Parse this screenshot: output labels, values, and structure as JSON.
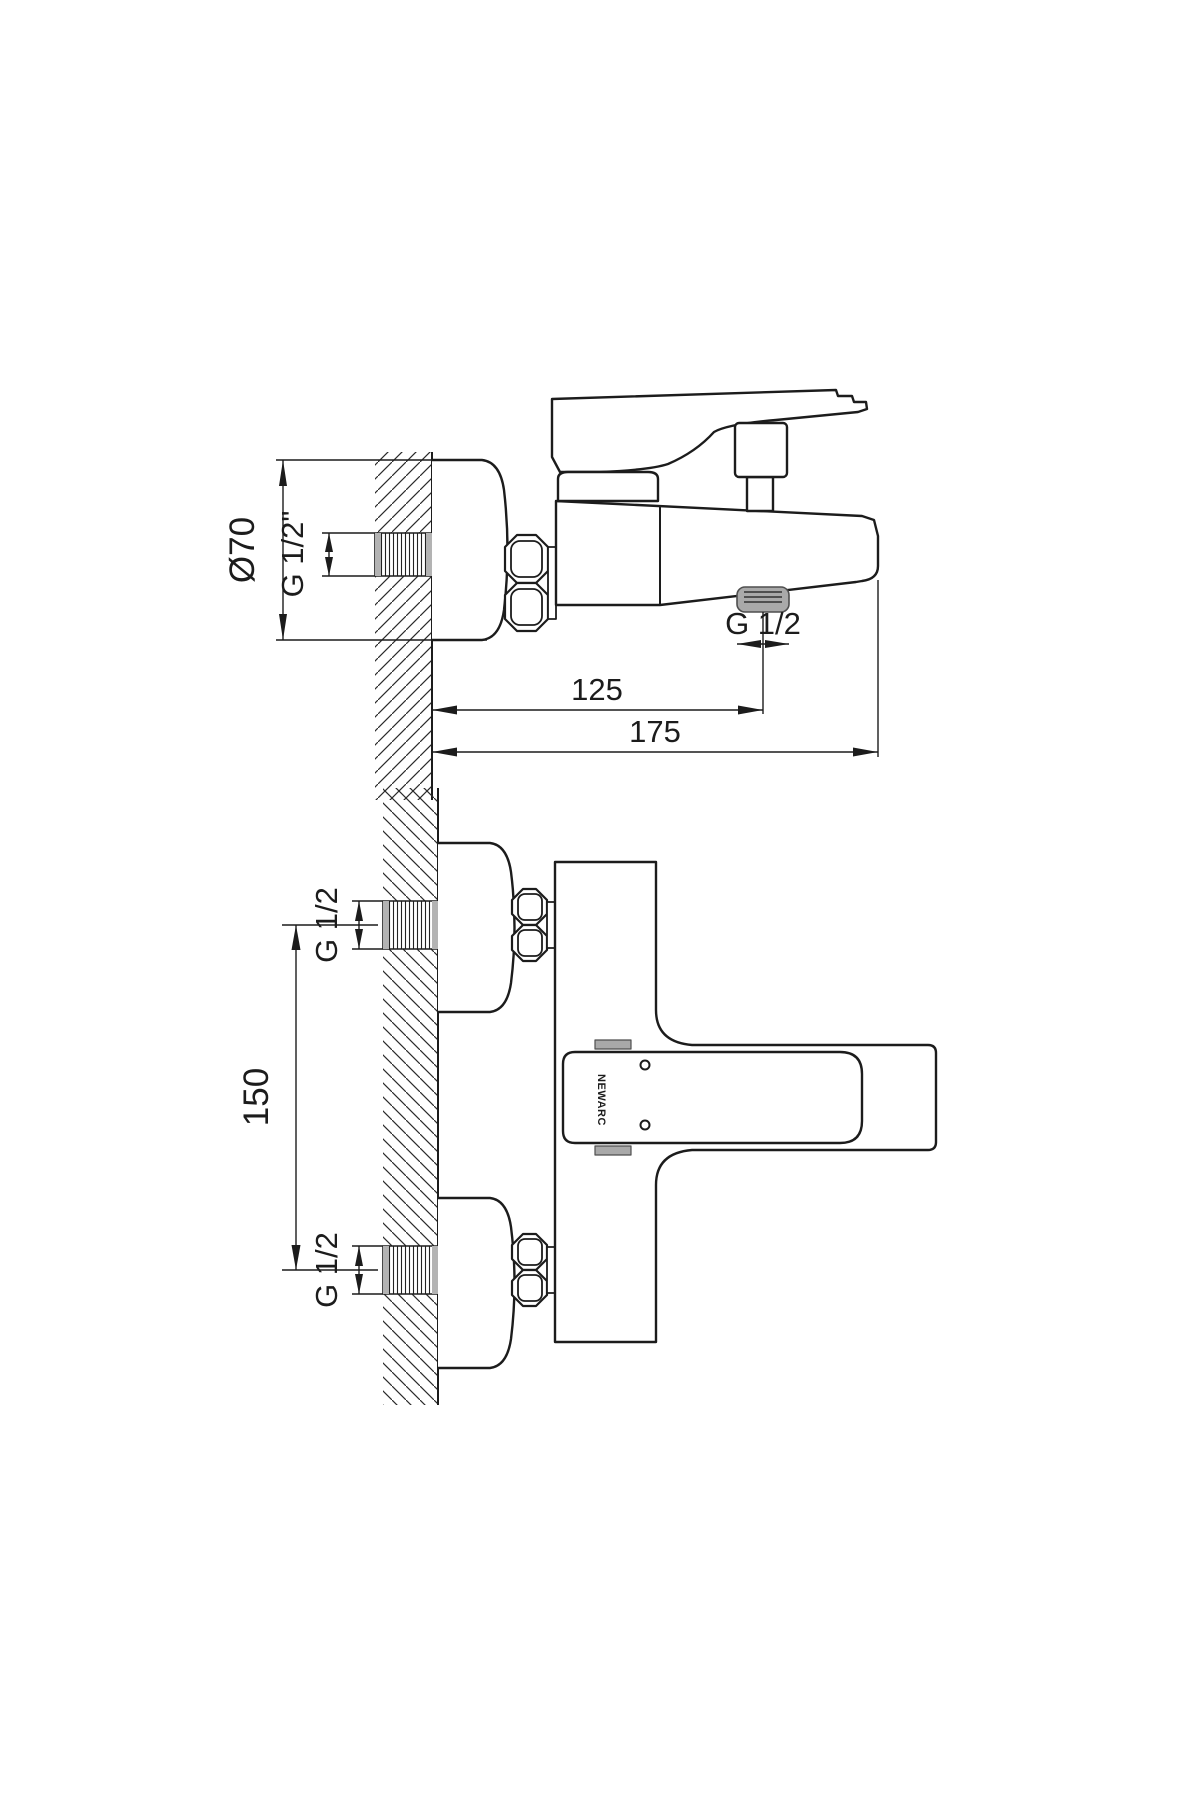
{
  "drawing": {
    "type": "technical-installation-drawing",
    "subject": "wall-mounted bath mixer faucet, two orthographic views"
  },
  "colors": {
    "line": "#1c1c1c",
    "dim_line": "#1c1c1c",
    "thread_gray": "#b3b3b3",
    "outlet_gray": "#a9a9a9",
    "outlet_dark": "#4f4f4f",
    "background": "#ffffff"
  },
  "side_view": {
    "flange_diameter_label": "Ø70",
    "wall_thread_label": "G 1/2\"",
    "outlet_thread_label": "G 1/2",
    "wall_to_outlet_label": "125",
    "wall_to_spout_tip_label": "175"
  },
  "front_view": {
    "top_inlet_thread_label": "G 1/2",
    "bottom_inlet_thread_label": "G 1/2",
    "inlet_spacing_label": "150",
    "brand_label": "NEWARC"
  }
}
